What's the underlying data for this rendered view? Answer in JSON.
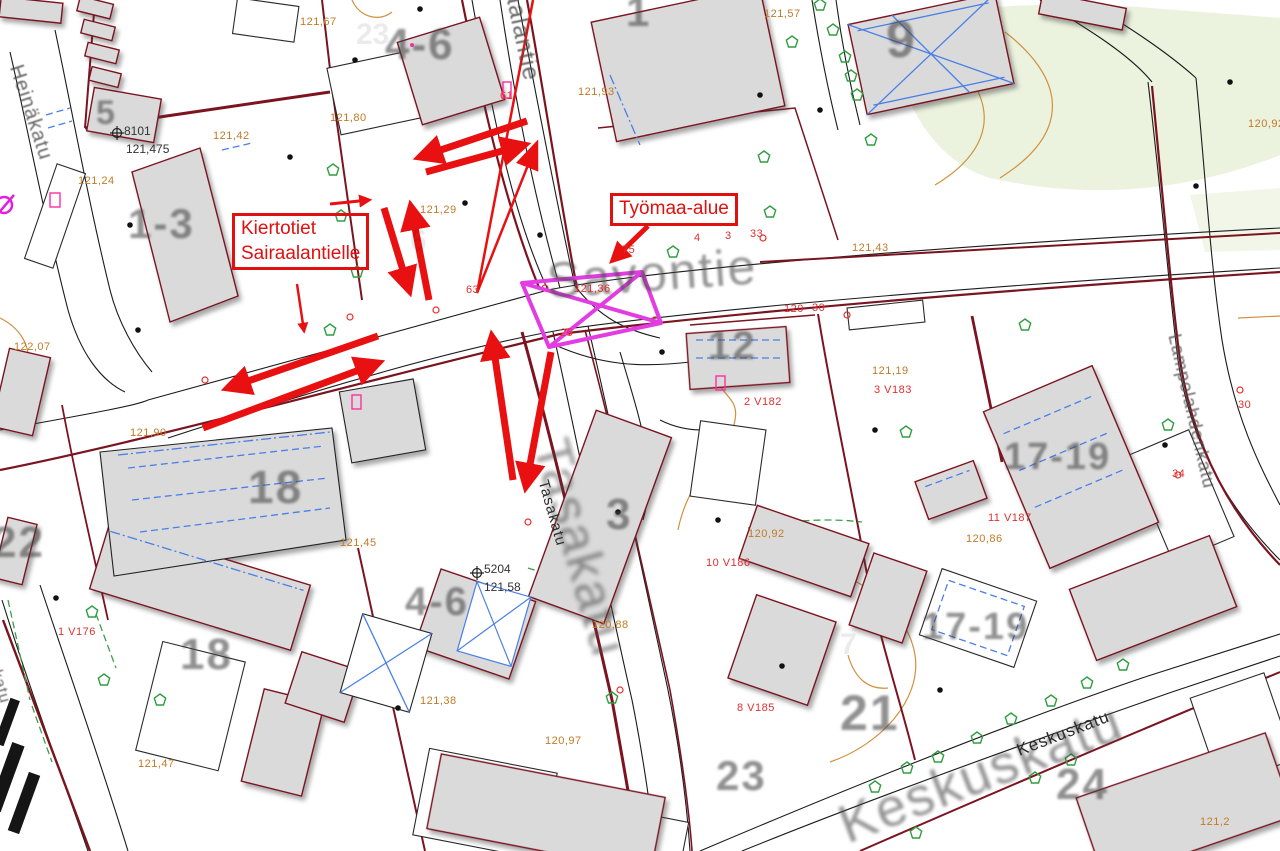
{
  "map": {
    "street_names": {
      "savontie": "Savontie",
      "sairaalantie": "Sairaalantie",
      "heinakatu": "Heinäkatu",
      "tasakatu": "Tasakatu",
      "keskuskatu": "Keskuskatu",
      "lampolahdenkatu": "Lampolahdenkatu",
      "street_partial": "katu"
    },
    "block_numbers": [
      "5",
      "1-3",
      "4-6",
      "4-6",
      "1",
      "9",
      "12",
      "18",
      "18",
      "22",
      "3",
      "17-19",
      "17-19",
      "21",
      "23",
      "24"
    ],
    "elevation_labels": [
      "121,67",
      "121,80",
      "121,42",
      "121,24",
      "121,93",
      "121,57",
      "121,29",
      "121,43",
      "121,19",
      "122,07",
      "121,90",
      "121,45",
      "120,88",
      "120,92",
      "120,86",
      "120,92",
      "121,38",
      "120,97",
      "121,47",
      "121,2"
    ],
    "red_labels": [
      "1 V176",
      "2 V182",
      "3 V183",
      "8 V185",
      "10 V186",
      "11 V187",
      "33",
      "121,36",
      "26",
      "61",
      "63",
      "75",
      "120",
      "30",
      "34",
      "30",
      "4",
      "3"
    ],
    "benchmarks": [
      {
        "id": "8101",
        "elevation": "121,475"
      },
      {
        "id": "5204",
        "elevation": "121,58"
      }
    ],
    "watermark_numbers": [
      "23",
      "6",
      "7"
    ]
  },
  "annotations": {
    "detour_note_line1": "Kiertotiet",
    "detour_note_line2": "Sairaalantielle",
    "work_area_label": "Työmaa-alue"
  },
  "colors": {
    "annotation_red": "#e01010",
    "work_area_magenta": "#e23ce2",
    "elevation_orange": "#c17b28",
    "parcel_maroon": "#7c1420",
    "detail_blue": "#4a7fe8",
    "vegetation_green": "#2e9e3e"
  }
}
